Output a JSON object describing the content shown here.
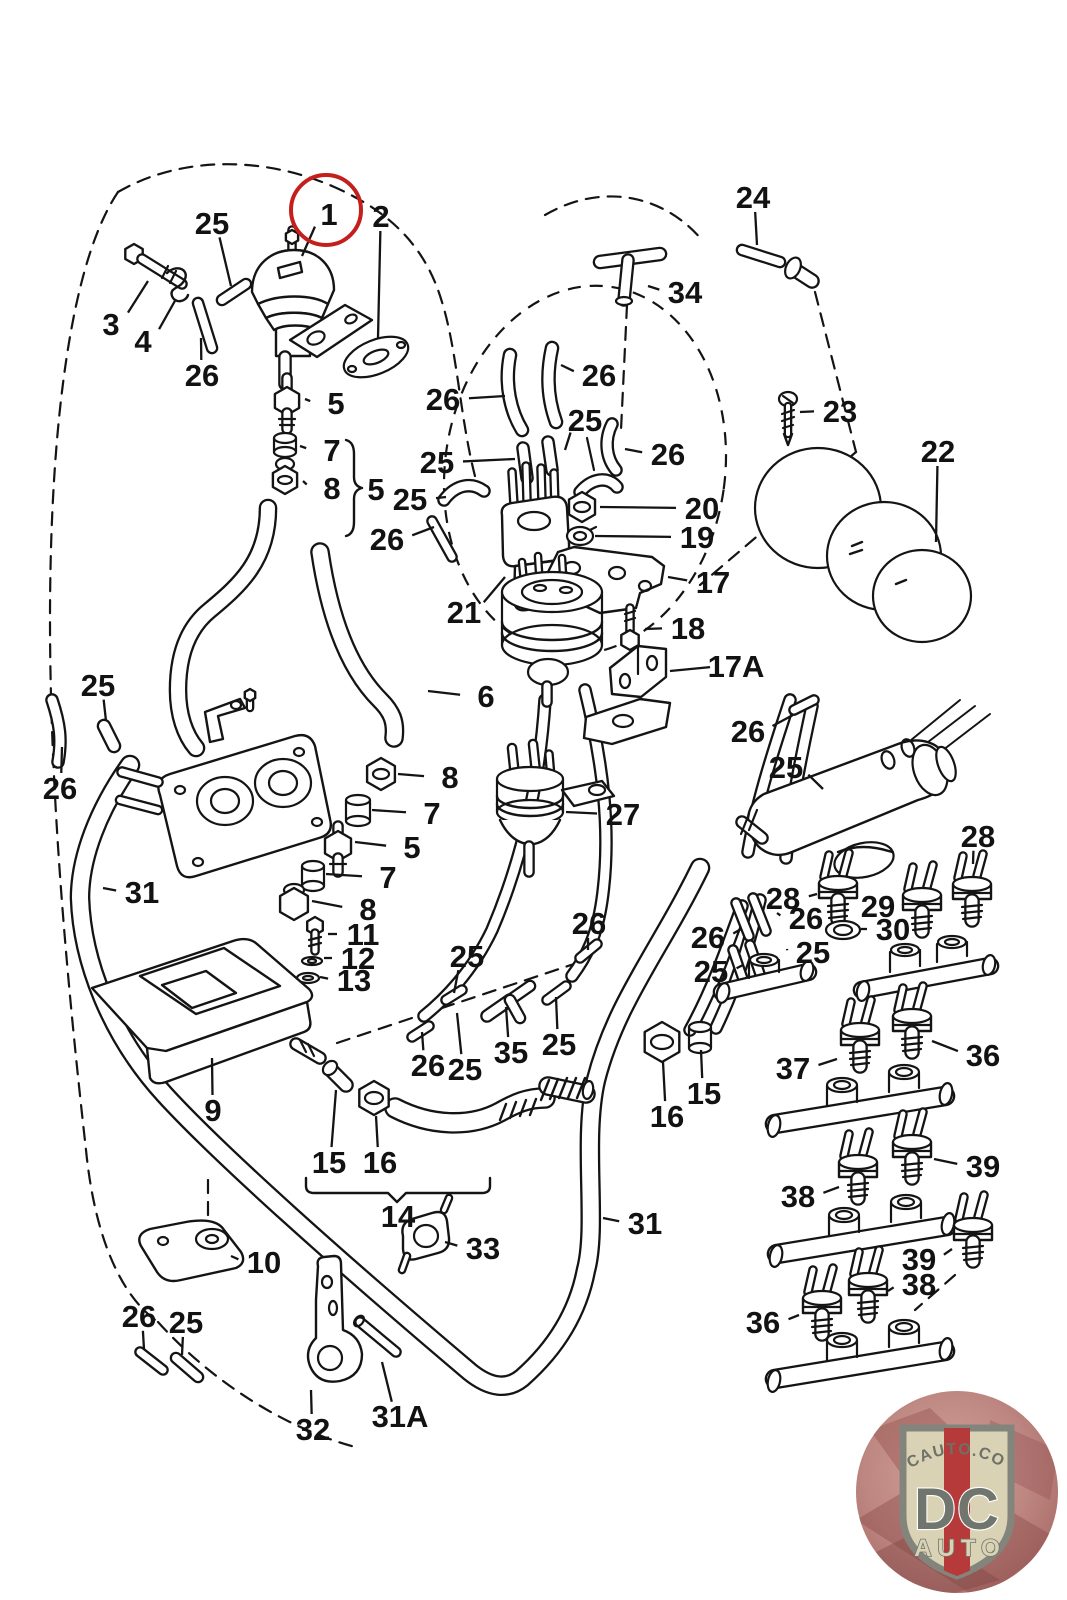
{
  "diagram": {
    "description_labels": "exploded-parts-callout-numbers",
    "line_color": "#141414",
    "highlight": {
      "part": "1",
      "color": "#c31f1c",
      "cx": 326,
      "cy": 210,
      "r": 35
    },
    "labels": [
      {
        "t": "25",
        "x": 212,
        "y": 223,
        "tx": 231,
        "ty": 286
      },
      {
        "t": "1",
        "x": 329,
        "y": 214,
        "tx": 302,
        "ty": 256
      },
      {
        "t": "2",
        "x": 381,
        "y": 216,
        "tx": 378,
        "ty": 338
      },
      {
        "t": "3",
        "x": 111,
        "y": 324,
        "tx": 148,
        "ty": 281
      },
      {
        "t": "4",
        "x": 143,
        "y": 341,
        "tx": 176,
        "ty": 299
      },
      {
        "t": "26",
        "x": 202,
        "y": 375,
        "tx": 201,
        "ty": 338
      },
      {
        "t": "5",
        "x": 336,
        "y": 403,
        "tx": 305,
        "ty": 399
      },
      {
        "t": "7",
        "x": 332,
        "y": 450,
        "tx": 300,
        "ty": 446
      },
      {
        "t": "8",
        "x": 332,
        "y": 488,
        "tx": 303,
        "ty": 481
      },
      {
        "t": "5",
        "x": 376,
        "y": 489
      },
      {
        "t": "24",
        "x": 753,
        "y": 197,
        "tx": 757,
        "ty": 245
      },
      {
        "t": "34",
        "x": 685,
        "y": 292,
        "tx": 648,
        "ty": 286
      },
      {
        "t": "26",
        "x": 599,
        "y": 375,
        "tx": 561,
        "ty": 365
      },
      {
        "t": "26",
        "x": 443,
        "y": 399,
        "tx": 505,
        "ty": 396
      },
      {
        "t": "25",
        "x": 585,
        "y": 420,
        "tx": 565,
        "ty": 450
      },
      {
        "t": "25",
        "x": 437,
        "y": 462,
        "tx": 515,
        "ty": 459
      },
      {
        "t": "26",
        "x": 668,
        "y": 454,
        "tx": 625,
        "ty": 449
      },
      {
        "t": "25",
        "x": 410,
        "y": 499,
        "tx": 446,
        "ty": 497
      },
      {
        "t": "26",
        "x": 387,
        "y": 539,
        "tx": 434,
        "ty": 527
      },
      {
        "t": "23",
        "x": 840,
        "y": 411,
        "tx": 800,
        "ty": 412
      },
      {
        "t": "22",
        "x": 938,
        "y": 451,
        "tx": 936,
        "ty": 542
      },
      {
        "t": "20",
        "x": 702,
        "y": 508,
        "tx": 600,
        "ty": 507
      },
      {
        "t": "19",
        "x": 697,
        "y": 537,
        "tx": 595,
        "ty": 536
      },
      {
        "t": "17",
        "x": 713,
        "y": 582,
        "tx": 668,
        "ty": 577
      },
      {
        "t": "18",
        "x": 688,
        "y": 628,
        "tx": 645,
        "ty": 629
      },
      {
        "t": "17A",
        "x": 736,
        "y": 666,
        "tx": 670,
        "ty": 671
      },
      {
        "t": "21",
        "x": 464,
        "y": 612,
        "tx": 505,
        "ty": 577
      },
      {
        "t": "6",
        "x": 486,
        "y": 696,
        "tx": 428,
        "ty": 691
      },
      {
        "t": "25",
        "x": 98,
        "y": 685,
        "tx": 106,
        "ty": 721
      },
      {
        "t": "26",
        "x": 60,
        "y": 788,
        "tx": 62,
        "ty": 747
      },
      {
        "t": "31",
        "x": 142,
        "y": 892,
        "tx": 103,
        "ty": 888
      },
      {
        "t": "8",
        "x": 450,
        "y": 777,
        "tx": 398,
        "ty": 774
      },
      {
        "t": "7",
        "x": 432,
        "y": 813,
        "tx": 372,
        "ty": 810
      },
      {
        "t": "5",
        "x": 412,
        "y": 847,
        "tx": 355,
        "ty": 842
      },
      {
        "t": "7",
        "x": 388,
        "y": 877,
        "tx": 326,
        "ty": 874
      },
      {
        "t": "8",
        "x": 368,
        "y": 909,
        "tx": 312,
        "ty": 901
      },
      {
        "t": "11",
        "x": 363,
        "y": 934,
        "tx": 328,
        "ty": 934
      },
      {
        "t": "12",
        "x": 358,
        "y": 958,
        "tx": 324,
        "ty": 958
      },
      {
        "t": "13",
        "x": 354,
        "y": 980,
        "tx": 320,
        "ty": 977
      },
      {
        "t": "27",
        "x": 623,
        "y": 814,
        "tx": 566,
        "ty": 812
      },
      {
        "t": "26",
        "x": 748,
        "y": 731,
        "tx": 793,
        "ty": 715
      },
      {
        "t": "25",
        "x": 786,
        "y": 767,
        "tx": 823,
        "ty": 789
      },
      {
        "t": "28",
        "x": 978,
        "y": 836,
        "tx": 973,
        "ty": 864
      },
      {
        "t": "28",
        "x": 783,
        "y": 898,
        "tx": 817,
        "ty": 894
      },
      {
        "t": "29",
        "x": 878,
        "y": 906,
        "tx": 902,
        "ty": 904
      },
      {
        "t": "30",
        "x": 893,
        "y": 929,
        "tx": 861,
        "ty": 929
      },
      {
        "t": "26",
        "x": 806,
        "y": 918,
        "tx": 777,
        "ty": 913
      },
      {
        "t": "25",
        "x": 813,
        "y": 952,
        "tx": 787,
        "ty": 949
      },
      {
        "t": "26",
        "x": 708,
        "y": 937,
        "tx": 741,
        "ty": 929
      },
      {
        "t": "25",
        "x": 711,
        "y": 971,
        "tx": 743,
        "ty": 965
      },
      {
        "t": "26",
        "x": 589,
        "y": 923,
        "tx": 588,
        "ty": 950
      },
      {
        "t": "25",
        "x": 467,
        "y": 956,
        "tx": 454,
        "ty": 993
      },
      {
        "t": "26",
        "x": 428,
        "y": 1065,
        "tx": 422,
        "ty": 1032
      },
      {
        "t": "25",
        "x": 465,
        "y": 1069,
        "tx": 457,
        "ty": 1013
      },
      {
        "t": "35",
        "x": 511,
        "y": 1052,
        "tx": 506,
        "ty": 1007
      },
      {
        "t": "25",
        "x": 559,
        "y": 1044,
        "tx": 556,
        "ty": 997
      },
      {
        "t": "9",
        "x": 213,
        "y": 1110,
        "tx": 212,
        "ty": 1058
      },
      {
        "t": "15",
        "x": 329,
        "y": 1162,
        "tx": 336,
        "ty": 1090
      },
      {
        "t": "16",
        "x": 380,
        "y": 1162,
        "tx": 376,
        "ty": 1116
      },
      {
        "t": "14",
        "x": 398,
        "y": 1216
      },
      {
        "t": "16",
        "x": 667,
        "y": 1116,
        "tx": 663,
        "ty": 1062
      },
      {
        "t": "15",
        "x": 704,
        "y": 1093,
        "tx": 701,
        "ty": 1050
      },
      {
        "t": "31",
        "x": 645,
        "y": 1223,
        "tx": 603,
        "ty": 1218
      },
      {
        "t": "10",
        "x": 264,
        "y": 1262,
        "tx": 231,
        "ty": 1256
      },
      {
        "t": "33",
        "x": 483,
        "y": 1248,
        "tx": 445,
        "ty": 1242
      },
      {
        "t": "26",
        "x": 139,
        "y": 1316,
        "tx": 144,
        "ty": 1349
      },
      {
        "t": "25",
        "x": 186,
        "y": 1322,
        "tx": 182,
        "ty": 1355
      },
      {
        "t": "32",
        "x": 313,
        "y": 1429,
        "tx": 311,
        "ty": 1390
      },
      {
        "t": "31A",
        "x": 400,
        "y": 1416,
        "tx": 382,
        "ty": 1362
      },
      {
        "t": "37",
        "x": 793,
        "y": 1068,
        "tx": 837,
        "ty": 1059
      },
      {
        "t": "36",
        "x": 983,
        "y": 1055,
        "tx": 932,
        "ty": 1041
      },
      {
        "t": "38",
        "x": 798,
        "y": 1196,
        "tx": 839,
        "ty": 1187
      },
      {
        "t": "39",
        "x": 983,
        "y": 1166,
        "tx": 934,
        "ty": 1159
      },
      {
        "t": "39",
        "x": 919,
        "y": 1259,
        "tx": 952,
        "ty": 1249
      },
      {
        "t": "38",
        "x": 919,
        "y": 1284,
        "tx": 888,
        "ty": 1291
      },
      {
        "t": "36",
        "x": 763,
        "y": 1322,
        "tx": 799,
        "ty": 1315
      }
    ]
  },
  "logo": {
    "site": "DCAUTO.COM",
    "brand": "DC",
    "sub": "AUTO",
    "shield_fill": "#d9d2b4",
    "stripe_color": "#b63a3a",
    "letter_color": "#70756e"
  }
}
